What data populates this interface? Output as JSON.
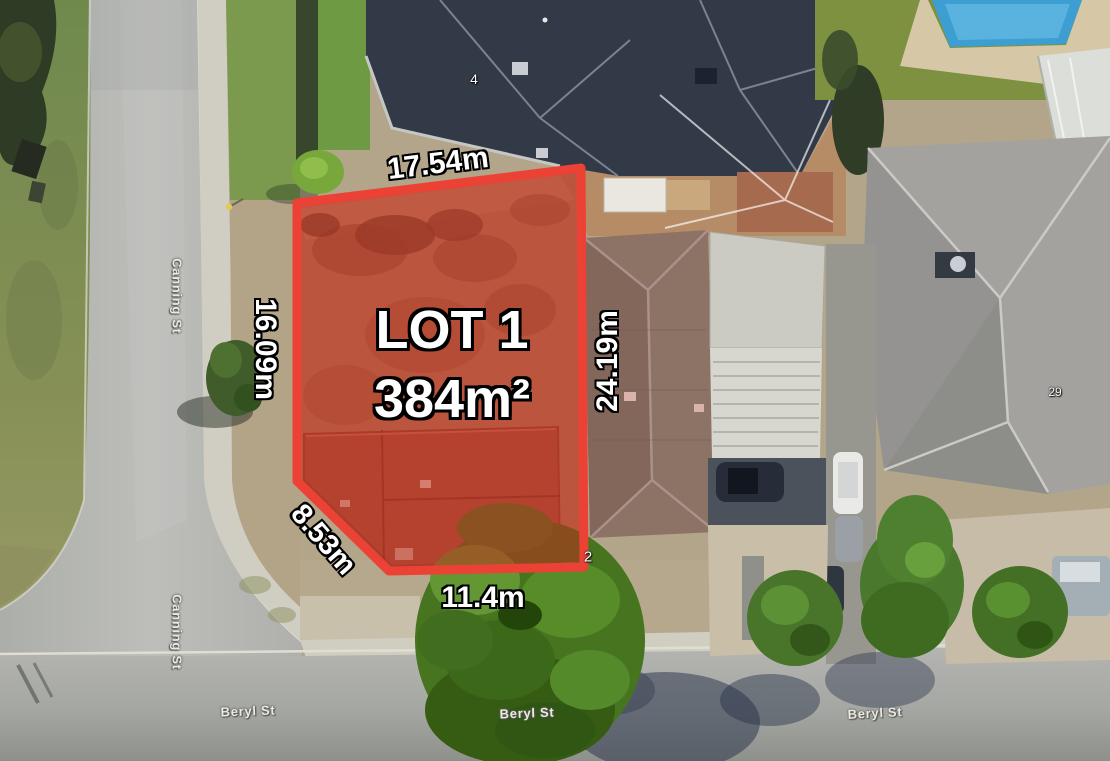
{
  "lot": {
    "name": "LOT 1",
    "area": "384m²",
    "dim_top": "17.54m",
    "dim_left": "16.09m",
    "dim_right": "24.19m",
    "dim_corner": "8.53m",
    "dim_bottom": "11.4m",
    "outline_color": "#ec4236",
    "fill_color": "rgba(201,38,27,0.5)"
  },
  "streets": {
    "canning_upper": "Canning St",
    "canning_lower": "Canning St",
    "beryl_left": "Beryl St",
    "beryl_center": "Beryl St",
    "beryl_right": "Beryl St"
  },
  "house_numbers": {
    "top": "4",
    "right": "29",
    "front": "2"
  }
}
